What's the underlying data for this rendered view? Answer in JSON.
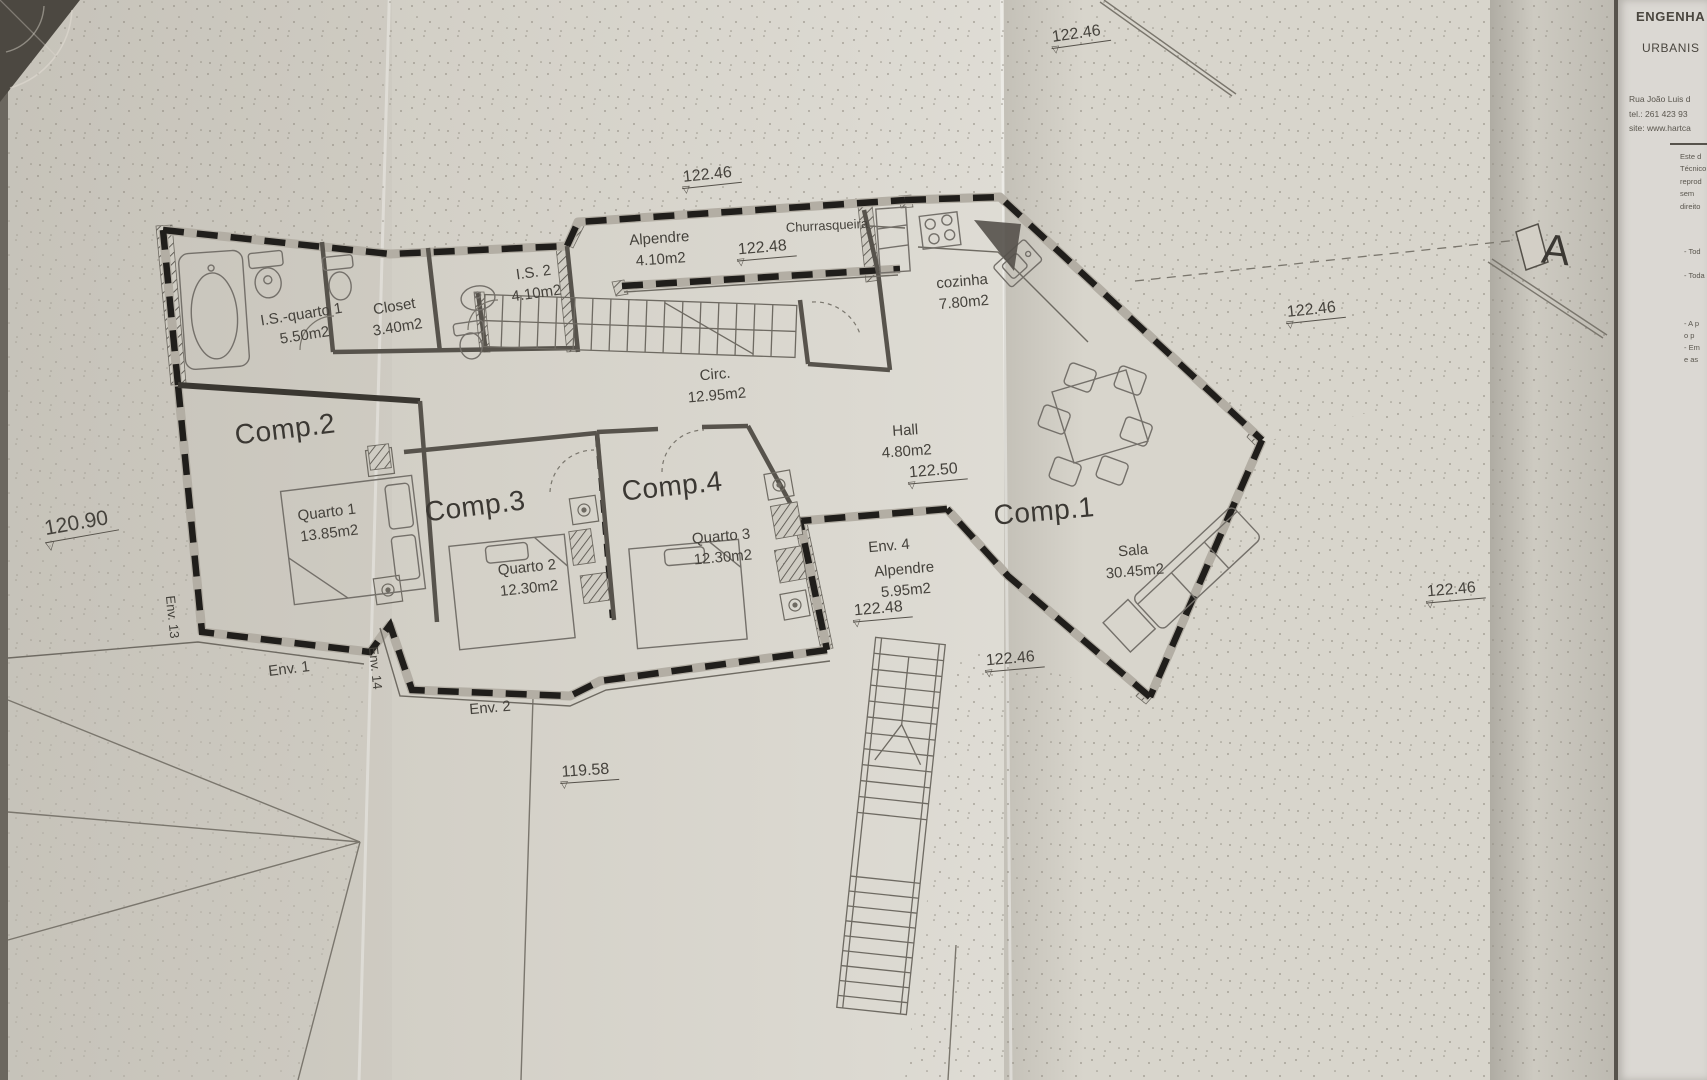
{
  "drawing": {
    "section_marker": "A",
    "rooms": {
      "alpendre_top": {
        "name": "Alpendre",
        "area": "4.10m2"
      },
      "churrasqueira": {
        "name": "Churrasqueira"
      },
      "is2": {
        "name": "I.S. 2",
        "area": "4.10m2"
      },
      "closet": {
        "name": "Closet",
        "area": "3.40m2"
      },
      "is_quarto1": {
        "name": "I.S.-quarto 1",
        "area": "5.50m2"
      },
      "cozinha": {
        "name": "cozinha",
        "area": "7.80m2"
      },
      "circ": {
        "name": "Circ.",
        "area": "12.95m2"
      },
      "hall": {
        "name": "Hall",
        "area": "4.80m2"
      },
      "comp1": {
        "name": "Comp.1"
      },
      "sala": {
        "name": "Sala",
        "area": "30.45m2"
      },
      "comp2": {
        "name": "Comp.2"
      },
      "quarto1": {
        "name": "Quarto 1",
        "area": "13.85m2"
      },
      "comp3": {
        "name": "Comp.3"
      },
      "quarto2": {
        "name": "Quarto 2",
        "area": "12.30m2"
      },
      "comp4": {
        "name": "Comp.4"
      },
      "quarto3": {
        "name": "Quarto 3",
        "area": "12.30m2"
      },
      "env1": {
        "name": "Env. 1"
      },
      "env2": {
        "name": "Env. 2"
      },
      "env4": {
        "name": "Env. 4"
      },
      "env4_alpendre": {
        "name": "Alpendre",
        "area": "5.95m2"
      },
      "env13": {
        "name": "Env. 13"
      },
      "env14": {
        "name": "Env. 14"
      }
    },
    "levels": {
      "top_center": "122.46",
      "upper_mid": "122.46",
      "porch": "122.48",
      "right_mid": "122.46",
      "hall_level": "122.50",
      "env4_level": "122.48",
      "lower_mid": "122.46",
      "right_low": "122.46",
      "west": "120.90",
      "south": "119.58"
    }
  },
  "title_block": {
    "line1": "ENGENHA",
    "line2": "URBANIS",
    "address1": "Rua João Luis d",
    "address2": "tel.: 261 423 93",
    "address3": "site: www.hartca",
    "note1": "Este d",
    "note2": "Técnico",
    "note3": "reprod",
    "note4": "sem",
    "note5": "direito",
    "item1": "- Tod",
    "item2": "- Toda",
    "item3": "- A p",
    "item4": "o p",
    "item5": "- Em",
    "item6": "e as"
  },
  "colors": {
    "paper": "#d8d5cc",
    "ink": "#201e1b",
    "line": "#6e6a62"
  }
}
